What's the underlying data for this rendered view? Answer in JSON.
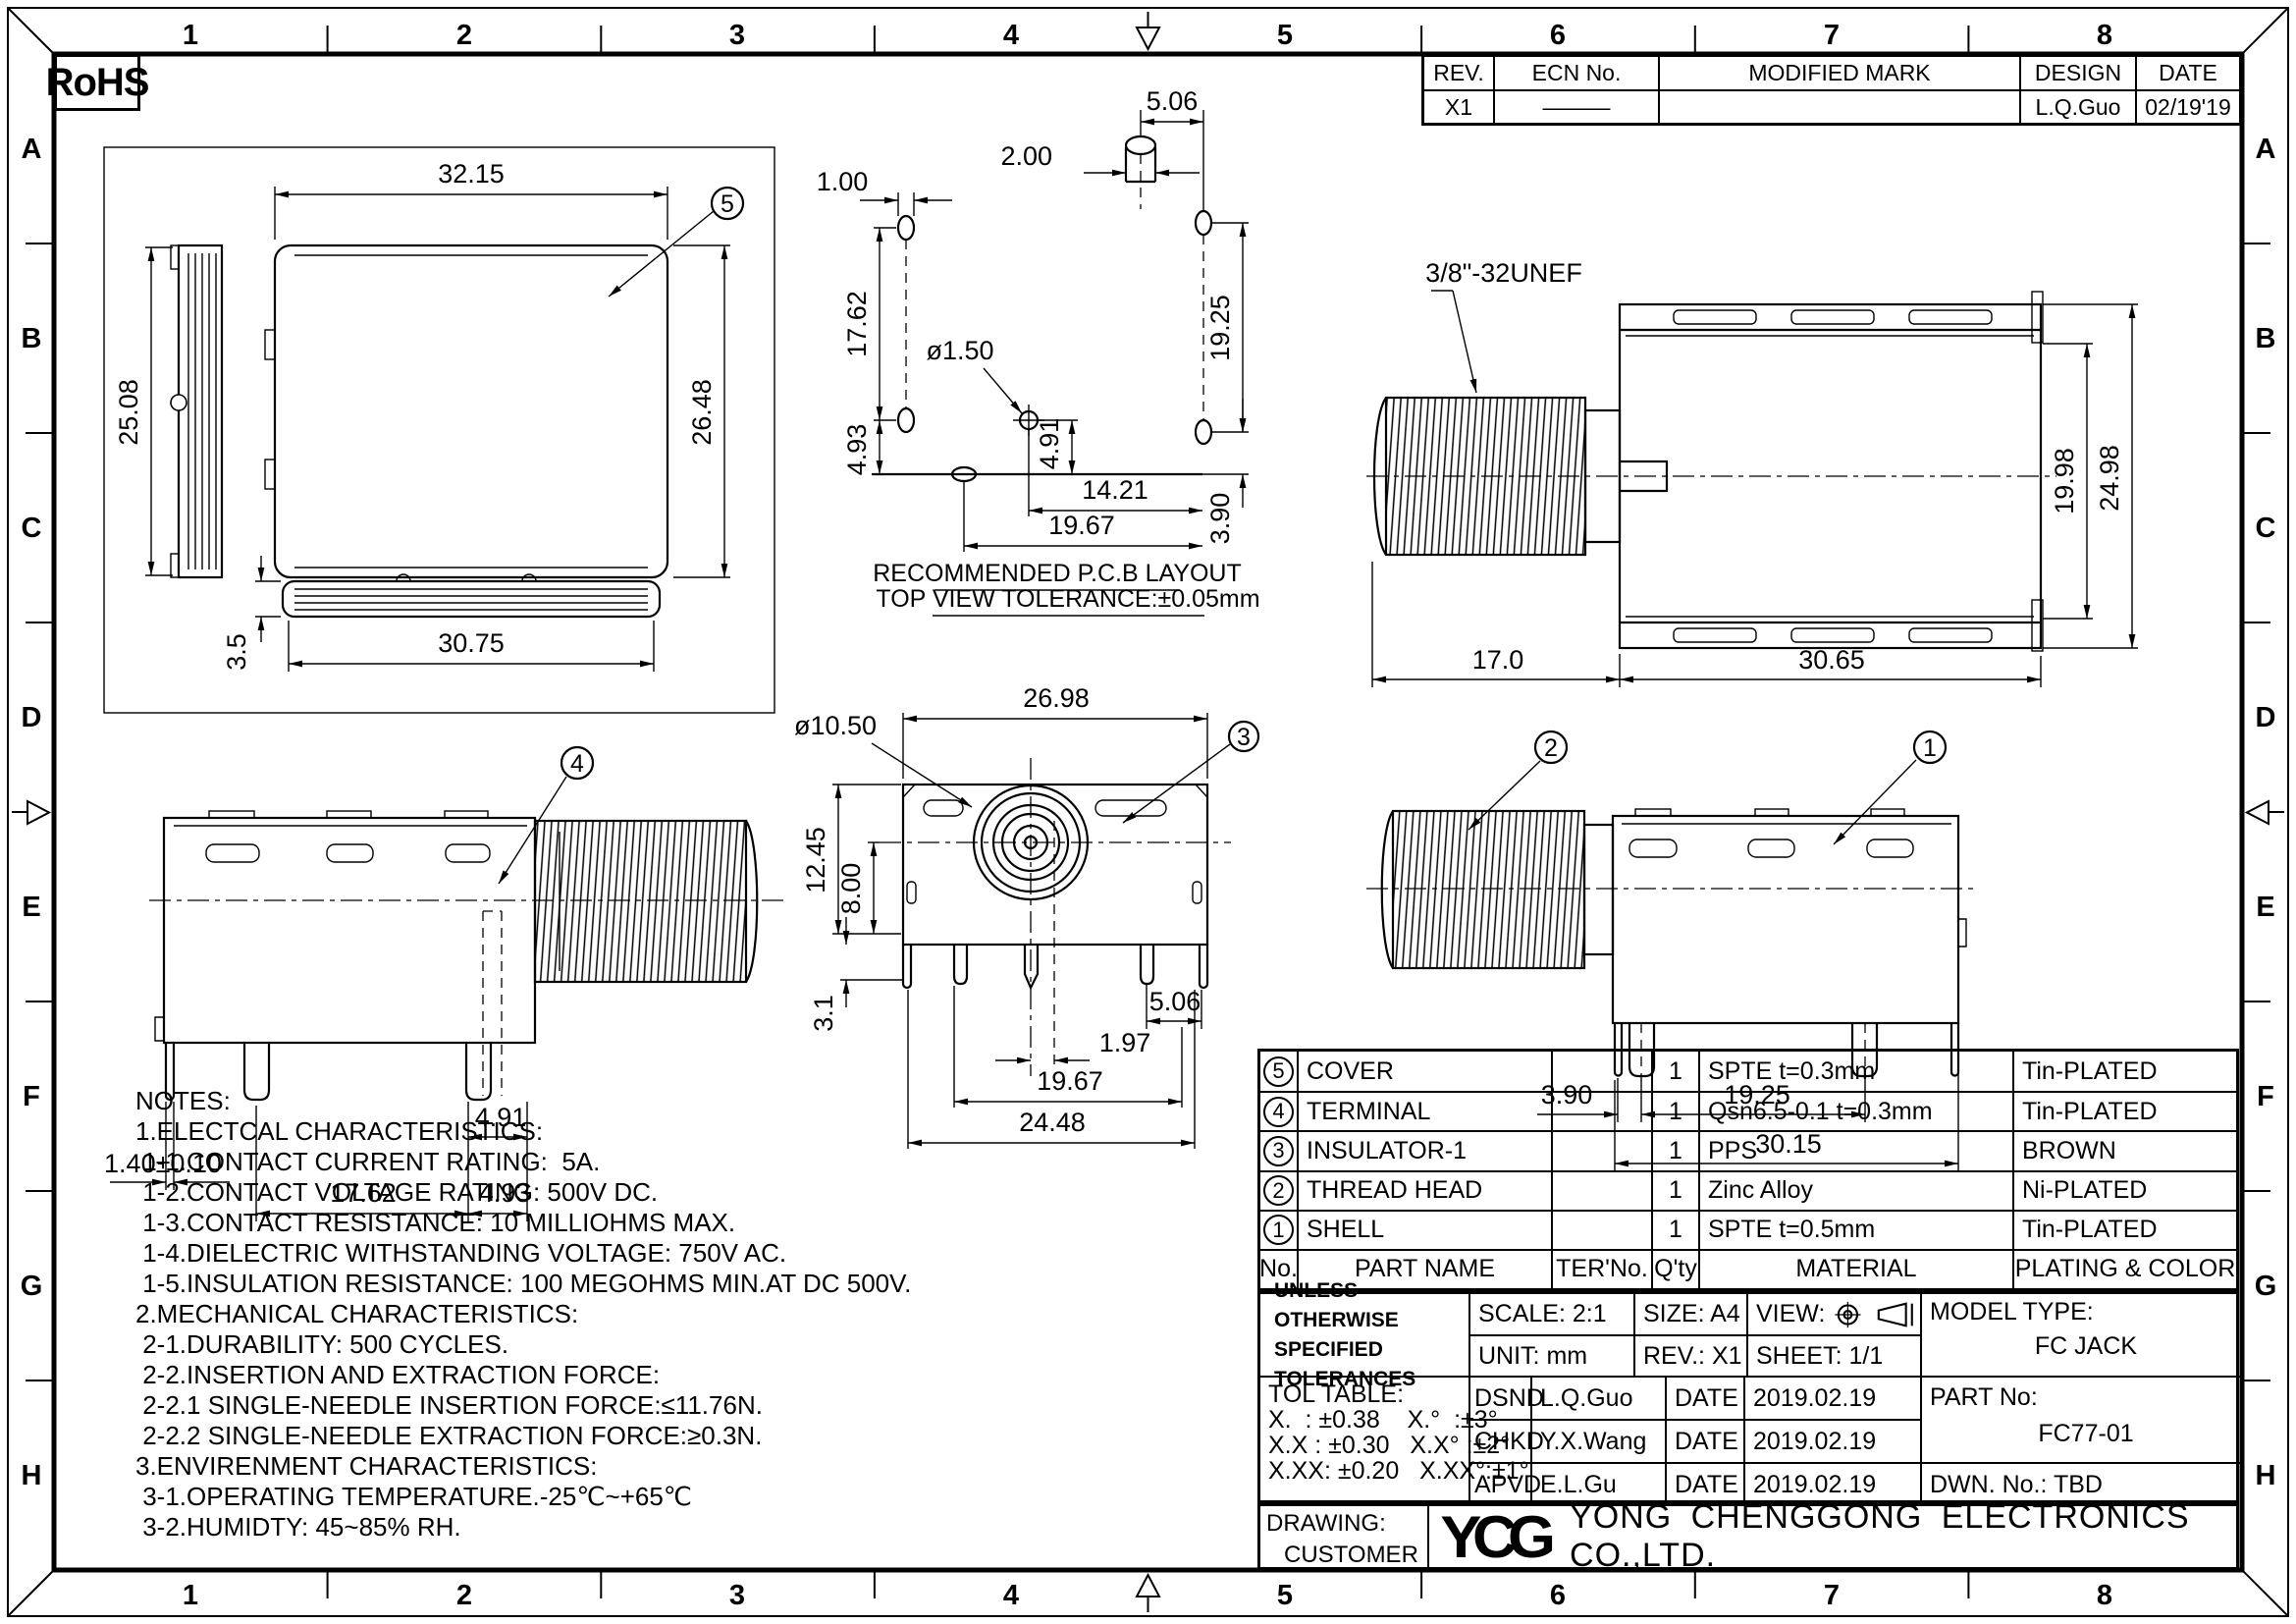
{
  "rohs_label": "RoHS",
  "zones": {
    "numbers": [
      "1",
      "2",
      "3",
      "4",
      "5",
      "6",
      "7",
      "8"
    ],
    "letters": [
      "A",
      "B",
      "C",
      "D",
      "E",
      "F",
      "G",
      "H"
    ]
  },
  "revision_table": {
    "headers": {
      "rev": "REV.",
      "ecn": "ECN No.",
      "mark": "MODIFIED MARK",
      "design": "DESIGN",
      "date": "DATE"
    },
    "row": {
      "rev": "X1",
      "ecn": "———",
      "mark": "",
      "design": "L.Q.Guo",
      "date": "02/19'19"
    }
  },
  "views": {
    "cover": {
      "balloon": "5",
      "dim_width": "32.15",
      "dim_height_side": "25.08",
      "dim_height": "26.48",
      "dim_bottom_width": "30.75",
      "dim_thickness": "3.5"
    },
    "pcb": {
      "caption": "RECOMMENDED P.C.B LAYOUT",
      "tolerance": "TOP VIEW TOLERANCE:±0.05mm",
      "dim_pitch_top": "5.06",
      "dim_pin_width": "2.00",
      "dim_hole_width": "1.00",
      "dim_left_v": "17.62",
      "dim_left_v2": "4.93",
      "dim_hole_dia": "ø1.50",
      "dim_center_v": "4.91",
      "dim_center_h": "14.21",
      "dim_bottom_h": "19.67",
      "dim_right_v": "19.25",
      "dim_right_v2": "3.90"
    },
    "top": {
      "thread_label": "3/8\"-32UNEF",
      "dim_inner_h": "19.98",
      "dim_outer_h": "24.98",
      "dim_thread_len": "17.0",
      "dim_body_len": "30.65"
    },
    "side_left": {
      "balloon": "4",
      "dim_tab": "1.40±0.10",
      "dim_pitch": "17.62",
      "dim_p2": "4.91",
      "dim_p3": "4.93"
    },
    "front": {
      "balloon": "3",
      "dim_width": "26.98",
      "dim_dia": "ø10.50",
      "dim_h1": "12.45",
      "dim_h2": "8.00",
      "dim_leg": "3.1",
      "dim_p1": "5.06",
      "dim_p2": "1.97",
      "dim_p3": "19.67",
      "dim_p4": "24.48"
    },
    "side_right": {
      "balloon_thread": "2",
      "balloon_shell": "1",
      "dim_p1": "3.90",
      "dim_p2": "19.25",
      "dim_p3": "30.15"
    }
  },
  "notes": {
    "text": "NOTES:\n1.ELECTCAL CHARACTERISTICS:\n 1-1.CONTACT CURRENT RATING:  5A.\n 1-2.CONTACT VOLTAGE RATING: 500V DC.\n 1-3.CONTACT RESISTANCE: 10 MILLIOHMS MAX.\n 1-4.DIELECTRIC WITHSTANDING VOLTAGE: 750V AC.\n 1-5.INSULATION RESISTANCE: 100 MEGOHMS MIN.AT DC 500V.\n2.MECHANICAL CHARACTERISTICS:\n 2-1.DURABILITY: 500 CYCLES.\n 2-2.INSERTION AND EXTRACTION FORCE:\n 2-2.1 SINGLE-NEEDLE INSERTION FORCE:≤11.76N.\n 2-2.2 SINGLE-NEEDLE EXTRACTION FORCE:≥0.3N.\n3.ENVIRENMENT CHARACTERISTICS:\n 3-1.OPERATING TEMPERATURE.-25℃~+65℃\n 3-2.HUMIDTY: 45~85% RH."
  },
  "bom": {
    "header": {
      "no": "No.",
      "part": "PART NAME",
      "ter": "TER'No.",
      "qty": "Q'ty",
      "material": "MATERIAL",
      "plating": "PLATING & COLOR"
    },
    "rows": [
      {
        "no": "5",
        "part": "COVER",
        "ter": "",
        "qty": "1",
        "material": "SPTE  t=0.3mm",
        "plating": "Tin-PLATED"
      },
      {
        "no": "4",
        "part": "TERMINAL",
        "ter": "",
        "qty": "1",
        "material": "Qsn6.5-0.1  t=0.3mm",
        "plating": "Tin-PLATED"
      },
      {
        "no": "3",
        "part": "INSULATOR-1",
        "ter": "",
        "qty": "1",
        "material": "PPS",
        "plating": "BROWN"
      },
      {
        "no": "2",
        "part": "THREAD HEAD",
        "ter": "",
        "qty": "1",
        "material": "Zinc  Alloy",
        "plating": "Ni-PLATED"
      },
      {
        "no": "1",
        "part": "SHELL",
        "ter": "",
        "qty": "1",
        "material": "SPTE  t=0.5mm",
        "plating": "Tin-PLATED"
      }
    ]
  },
  "title_block": {
    "tol_note1": "UNLESS OTHERWISE",
    "tol_note2": "SPECIFIED TOLERANCES",
    "scale": "SCALE: 2:1",
    "unit": "UNIT:  mm",
    "size": "SIZE:  A4",
    "rev": "REV.:  X1",
    "view_label": "VIEW:",
    "sheet": "SHEET:  1/1",
    "model_label": "MODEL TYPE:",
    "model": "FC JACK",
    "tol_table": "TOL TABLE:\nX.  : ±0.38    X.°  :±3°\nX.X : ±0.30   X.X° :±2°\nX.XX: ±0.20   X.XX°:±1°",
    "rows": [
      {
        "role": "DSND",
        "name": "L.Q.Guo",
        "date_label": "DATE",
        "date": "2019.02.19"
      },
      {
        "role": "CHKD",
        "name": "Y.X.Wang",
        "date_label": "DATE",
        "date": "2019.02.19"
      },
      {
        "role": "APVD",
        "name": "E.L.Gu",
        "date_label": "DATE",
        "date": "2019.02.19"
      }
    ],
    "part_no_label": "PART No:",
    "part_no": "FC77-01",
    "dwn_no": "DWN.  No.:  TBD"
  },
  "company": {
    "drawing_label": "DRAWING:",
    "customer": "CUSTOMER",
    "logo": "YCG",
    "name": "YONG  CHENGGONG  ELECTRONICS  CO.,LTD."
  }
}
